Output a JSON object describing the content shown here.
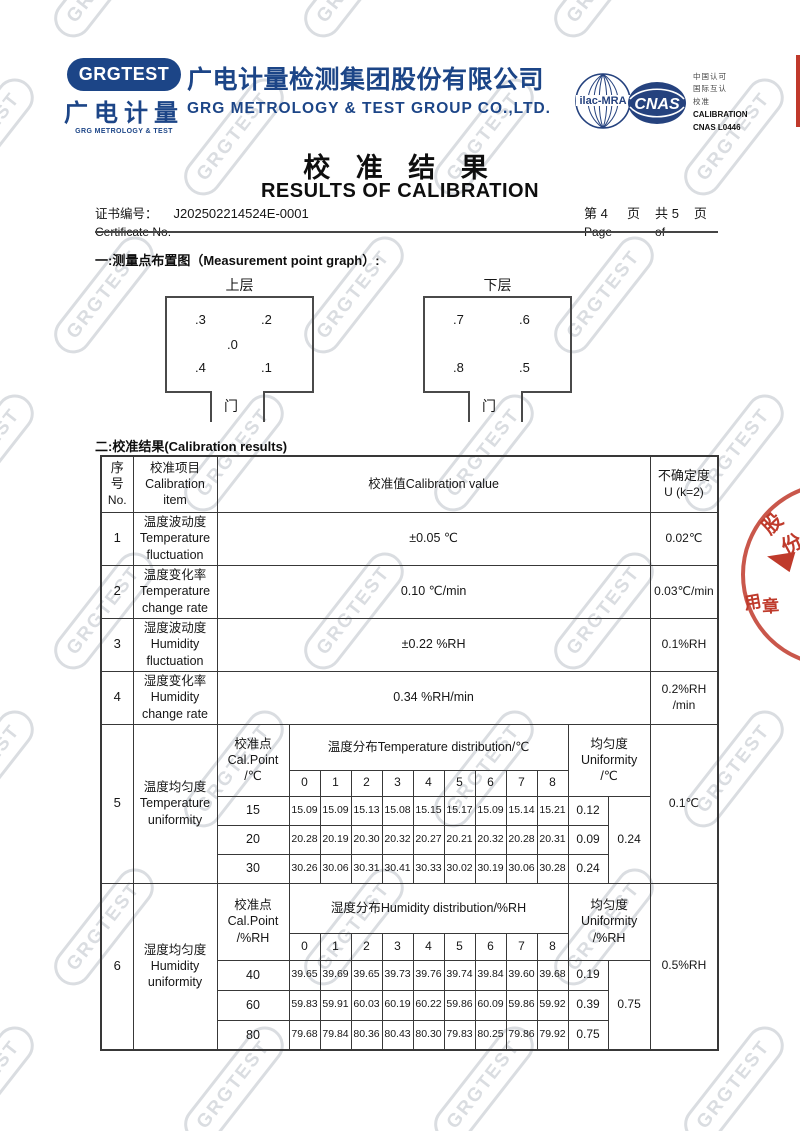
{
  "watermark": {
    "text": "GRGTEST"
  },
  "header": {
    "logo_badge": "GRGTEST",
    "logo_cn": "广电计量",
    "logo_en": "GRG METROLOGY & TEST",
    "company_cn": "广电计量检测集团股份有限公司",
    "company_en": "GRG METROLOGY & TEST GROUP CO.,LTD.",
    "ilac_label": "ilac-MRA",
    "cnas_label": "CNAS",
    "accred_cn1": "中国认可",
    "accred_cn2": "国际互认",
    "accred_cn3": "校准",
    "accred_en1": "CALIBRATION",
    "accred_en2": "CNAS L0446",
    "brand_color": "#1c4587"
  },
  "title": {
    "cn": "校 准 结 果",
    "en": "RESULTS OF CALIBRATION"
  },
  "certificate": {
    "label_cn": "证书编号：",
    "label_en": "Certificate No.",
    "number": "J202502214524E-0001",
    "page_prefix": "第",
    "page_num": "4",
    "page_char": "页",
    "total_prefix": "共",
    "total_num": "5",
    "total_char": "页",
    "page_label": "Page",
    "of_label": "of"
  },
  "section1": {
    "heading": "一:测量点布置图（Measurement point graph）:",
    "upper": {
      "title": "上层",
      "p_tl": ".3",
      "p_tr": ".2",
      "p_ctr": ".0",
      "p_bl": ".4",
      "p_br": ".1",
      "door": "门"
    },
    "lower": {
      "title": "下层",
      "p_tl": ".7",
      "p_tr": ".6",
      "p_bl": ".8",
      "p_br": ".5",
      "door": "门"
    }
  },
  "section2": {
    "heading": "二:校准结果(Calibration results)",
    "th": {
      "no1": "序",
      "no2": "号",
      "no3": "No.",
      "item1": "校准项目",
      "item2": "Calibration",
      "item3": "item",
      "value": "校准值Calibration value",
      "unc1": "不确定度",
      "unc2": "U (k=2)"
    },
    "rows": [
      {
        "no": "1",
        "item1": "温度波动度",
        "item2": "Temperature",
        "item3": "fluctuation",
        "value": "±0.05 ℃",
        "unc": "0.02℃"
      },
      {
        "no": "2",
        "item1": "温度变化率",
        "item2": "Temperature",
        "item3": "change rate",
        "value": "0.10 ℃/min",
        "unc": "0.03℃/min"
      },
      {
        "no": "3",
        "item1": "湿度波动度",
        "item2": "Humidity",
        "item3": "fluctuation",
        "value": "±0.22 %RH",
        "unc": "0.1%RH"
      },
      {
        "no": "4",
        "item1": "湿度变化率",
        "item2": "Humidity",
        "item3": "change rate",
        "value": "0.34 %RH/min",
        "unc": "0.2%RH /min"
      }
    ],
    "blocks": [
      {
        "no": "5",
        "item1": "温度均匀度",
        "item2": "Temperature",
        "item3": "uniformity",
        "cal1": "校准点",
        "cal2": "Cal.Point",
        "cal3": "/℃",
        "dist": "温度分布Temperature distribution/℃",
        "cols": [
          "0",
          "1",
          "2",
          "3",
          "4",
          "5",
          "6",
          "7",
          "8"
        ],
        "uni1": "均匀度",
        "uni2": "Uniformity",
        "uni3": "/℃",
        "rows": [
          {
            "point": "15",
            "values": [
              "15.09",
              "15.09",
              "15.13",
              "15.08",
              "15.15",
              "15.17",
              "15.09",
              "15.14",
              "15.21"
            ],
            "uni": "0.12"
          },
          {
            "point": "20",
            "values": [
              "20.28",
              "20.19",
              "20.30",
              "20.32",
              "20.27",
              "20.21",
              "20.32",
              "20.28",
              "20.31"
            ],
            "uni": "0.09"
          },
          {
            "point": "30",
            "values": [
              "30.26",
              "30.06",
              "30.31",
              "30.41",
              "30.33",
              "30.02",
              "30.19",
              "30.06",
              "30.28"
            ],
            "uni": "0.24"
          }
        ],
        "overall": "0.24",
        "unc": "0.1℃"
      },
      {
        "no": "6",
        "item1": "湿度均匀度",
        "item2": "Humidity",
        "item3": "uniformity",
        "cal1": "校准点",
        "cal2": "Cal.Point",
        "cal3": "/%RH",
        "dist": "湿度分布Humidity distribution/%RH",
        "cols": [
          "0",
          "1",
          "2",
          "3",
          "4",
          "5",
          "6",
          "7",
          "8"
        ],
        "uni1": "均匀度",
        "uni2": "Uniformity",
        "uni3": "/%RH",
        "rows": [
          {
            "point": "40",
            "values": [
              "39.65",
              "39.69",
              "39.65",
              "39.73",
              "39.76",
              "39.74",
              "39.84",
              "39.60",
              "39.68"
            ],
            "uni": "0.19"
          },
          {
            "point": "60",
            "values": [
              "59.83",
              "59.91",
              "60.03",
              "60.19",
              "60.22",
              "59.86",
              "60.09",
              "59.86",
              "59.92"
            ],
            "uni": "0.39"
          },
          {
            "point": "80",
            "values": [
              "79.68",
              "79.84",
              "80.36",
              "80.43",
              "80.30",
              "79.83",
              "80.25",
              "79.86",
              "79.92"
            ],
            "uni": "0.75"
          }
        ],
        "overall": "0.75",
        "unc": "0.5%RH"
      }
    ]
  },
  "stamp": {
    "c1": "股",
    "c2": "份",
    "c3": "用",
    "c4": "章"
  }
}
